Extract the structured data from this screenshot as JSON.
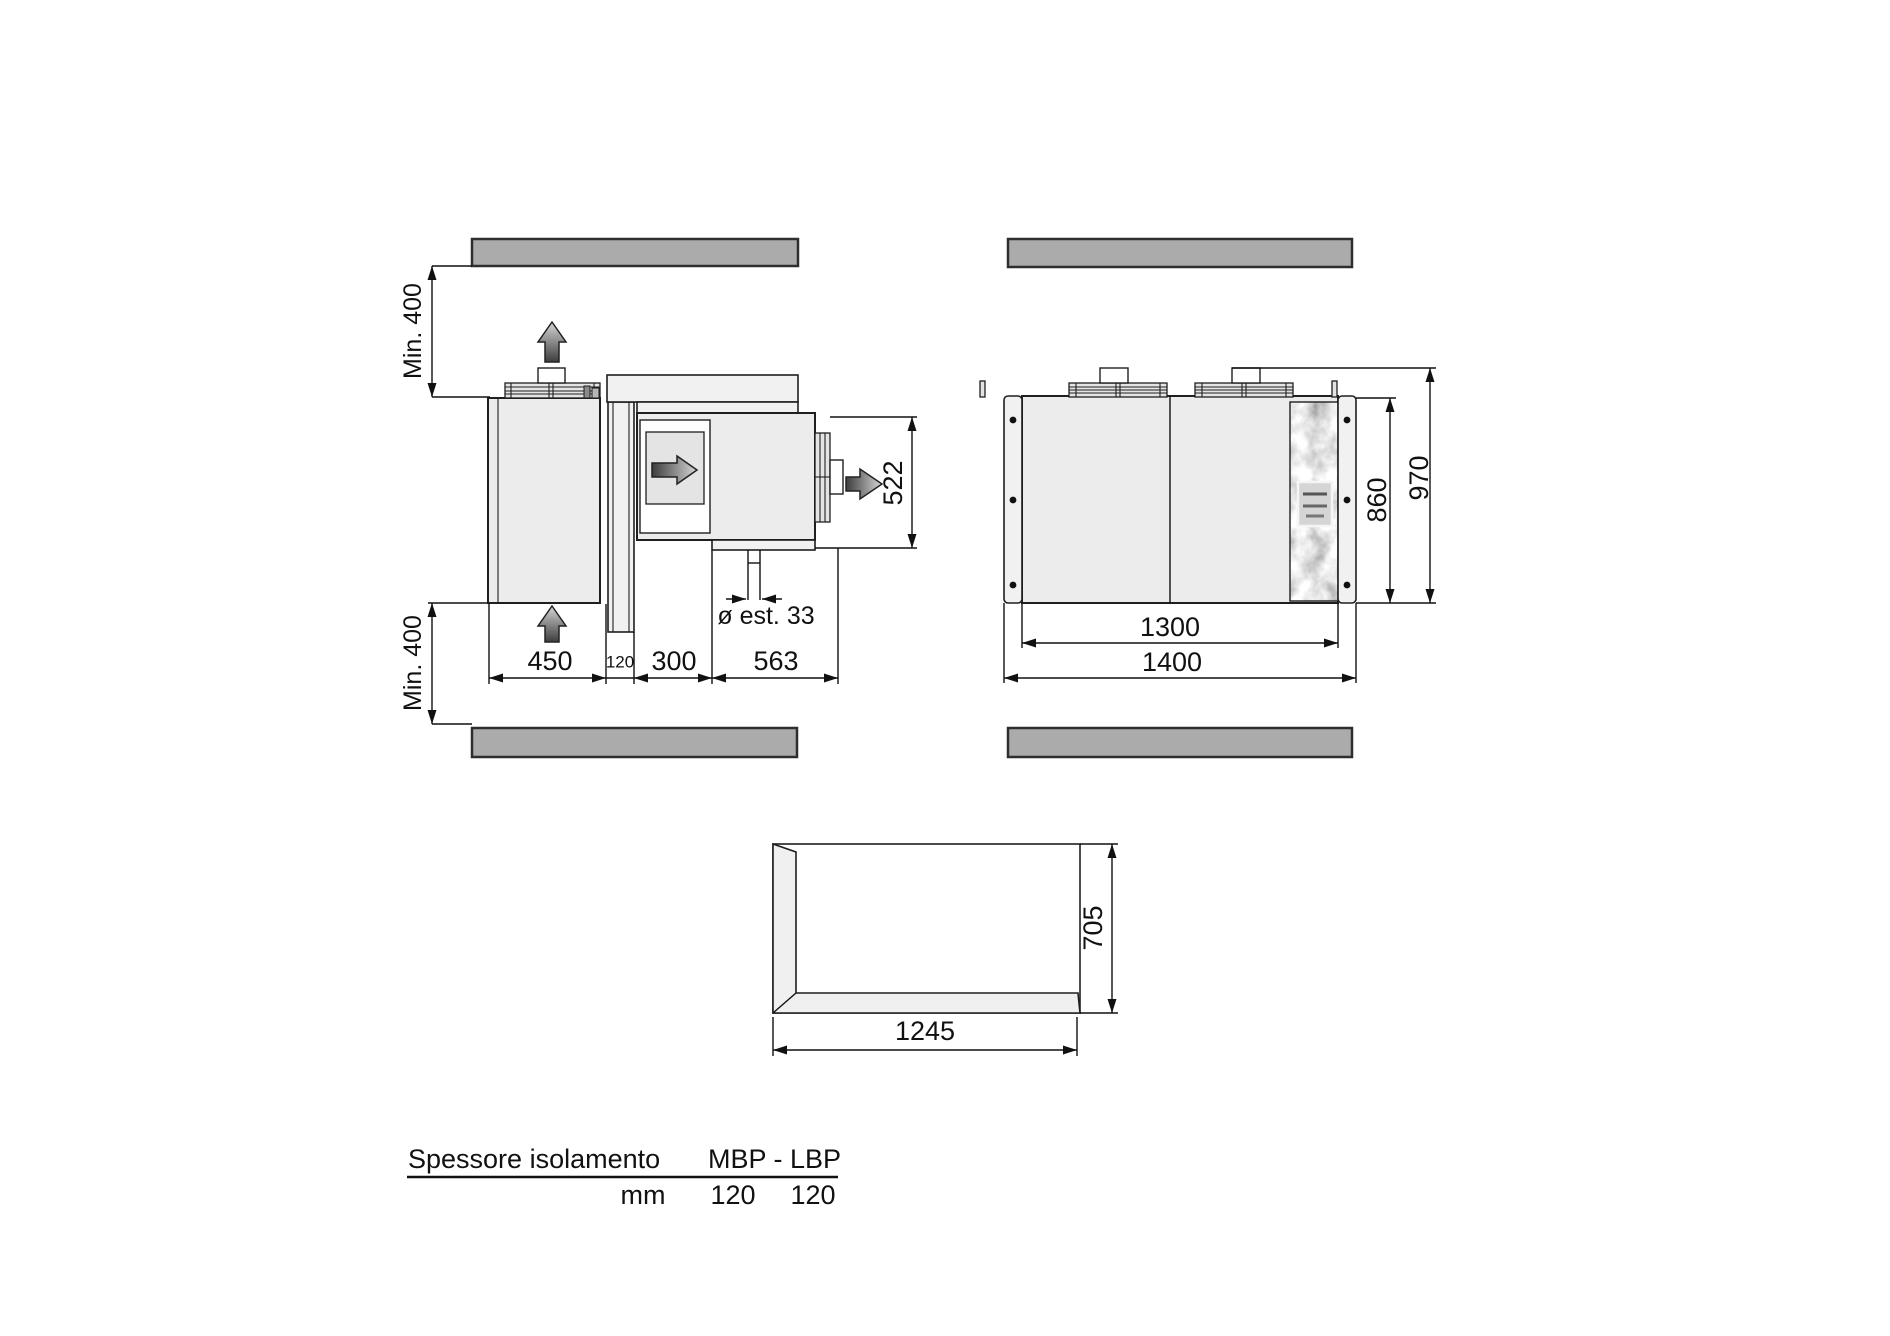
{
  "side_view": {
    "clearance_top": "Min. 400",
    "clearance_bottom": "Min. 400",
    "depth_evaporator": "450",
    "wall_thickness": "120",
    "gap_wall_condenser": "300",
    "depth_condenser": "563",
    "height_condenser": "522",
    "drain_pipe": "ø est. 33"
  },
  "front_view": {
    "height_body": "860",
    "height_overall": "970",
    "width_body": "1300",
    "width_overall": "1400"
  },
  "opening": {
    "height": "705",
    "width": "1245"
  },
  "table": {
    "header_label": "Spessore isolamento",
    "header_value": "MBP - LBP",
    "unit_label": "mm",
    "values": [
      "120",
      "120"
    ]
  },
  "colors": {
    "wall_gray": "#ababab",
    "panel_gray": "#ececec",
    "line": "#1a1a1a"
  }
}
